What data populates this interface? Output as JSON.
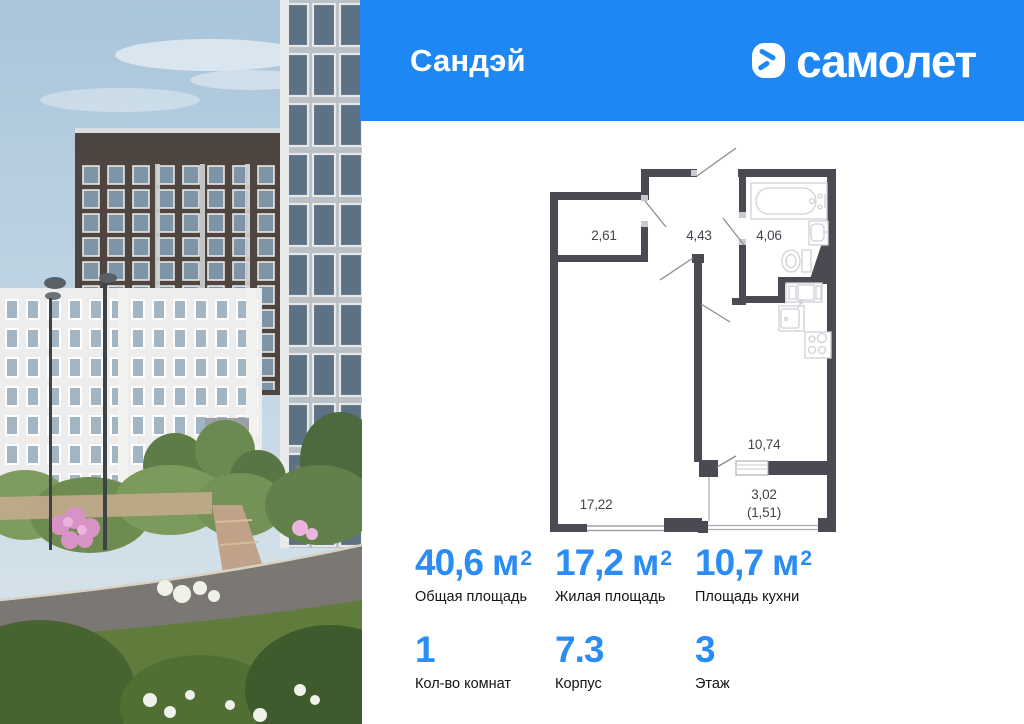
{
  "header": {
    "project_name": "Сандэй",
    "brand_name": "самолет",
    "background_color": "#1f87f3"
  },
  "floor_plan": {
    "wall_color": "#4a4a52",
    "rooms": [
      {
        "name": "closet",
        "area_label": "2,61"
      },
      {
        "name": "hallway",
        "area_label": "4,43"
      },
      {
        "name": "bathroom",
        "area_label": "4,06"
      },
      {
        "name": "living-room",
        "area_label": "17,22"
      },
      {
        "name": "kitchen",
        "area_label": "10,74"
      },
      {
        "name": "balcony",
        "area_label": "3,02"
      },
      {
        "name": "balcony-reduced",
        "area_label": "(1,51)"
      }
    ]
  },
  "stats": {
    "accent_color": "#2b8cf6",
    "cells": [
      {
        "value": "40,6",
        "unit": "м",
        "unit_sup": "2",
        "label": "Общая площадь"
      },
      {
        "value": "17,2",
        "unit": "м",
        "unit_sup": "2",
        "label": "Жилая площадь"
      },
      {
        "value": "10,7",
        "unit": "м",
        "unit_sup": "2",
        "label": "Площадь кухни"
      },
      {
        "value": "1",
        "label": "Кол-во комнат"
      },
      {
        "value": "7.3",
        "label": "Корпус"
      },
      {
        "value": "3",
        "label": "Этаж"
      }
    ]
  }
}
